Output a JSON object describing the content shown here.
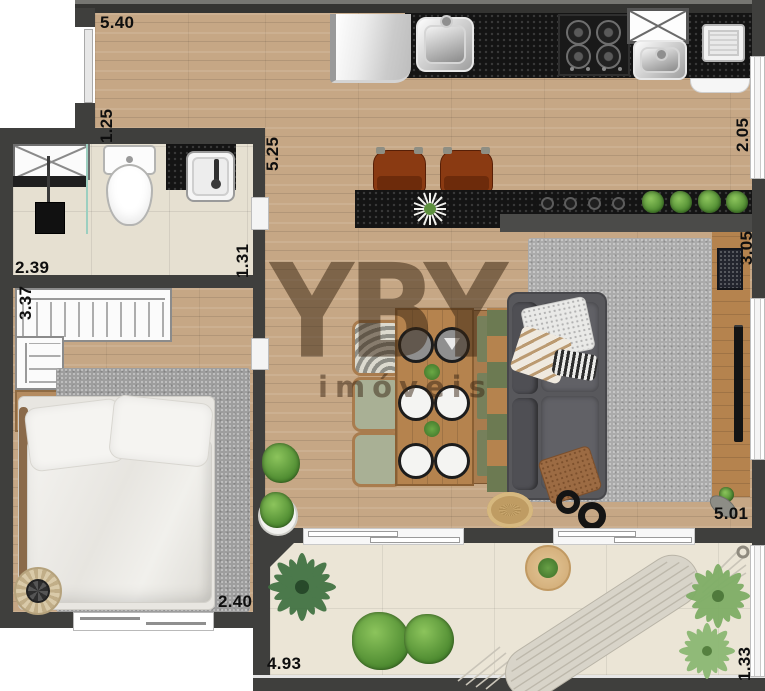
{
  "watermark": {
    "brand": "YBY",
    "subtitle": "imóveis"
  },
  "measurements": [
    {
      "value": "5.40",
      "orientation": "horizontal",
      "location": "entry-top-wall"
    },
    {
      "value": "1.25",
      "orientation": "vertical",
      "location": "entry-left-wall"
    },
    {
      "value": "5.25",
      "orientation": "vertical",
      "location": "kitchen-left"
    },
    {
      "value": "2.05",
      "orientation": "vertical",
      "location": "kitchen-right-window"
    },
    {
      "value": "2.39",
      "orientation": "horizontal",
      "location": "bathroom-width"
    },
    {
      "value": "1.31",
      "orientation": "vertical",
      "location": "bathroom-right"
    },
    {
      "value": "3.37",
      "orientation": "vertical",
      "location": "closet-left"
    },
    {
      "value": "3.05",
      "orientation": "vertical",
      "location": "living-right"
    },
    {
      "value": "2.40",
      "orientation": "horizontal",
      "location": "bedroom-width"
    },
    {
      "value": "5.01",
      "orientation": "horizontal",
      "location": "living-bottom"
    },
    {
      "value": "4.93",
      "orientation": "horizontal",
      "location": "balcony-width"
    },
    {
      "value": "1.33",
      "orientation": "vertical",
      "location": "balcony-right"
    }
  ],
  "colors": {
    "wall": "#3f3f3d",
    "wood_floor": "#c6a785",
    "counter_black": "#141414",
    "bathroom_tile": "#e6e0d1",
    "balcony_tile": "#ebe5d6",
    "rug_gray": "#ababab",
    "sofa_gray": "#58585c",
    "furniture_wood": "#b5834e",
    "stool_brown": "#8a3a12",
    "plant_green": "#4d8a30",
    "watermark_brown": "rgba(58,38,20,0.52)",
    "label_text": "#0e0e0e"
  }
}
